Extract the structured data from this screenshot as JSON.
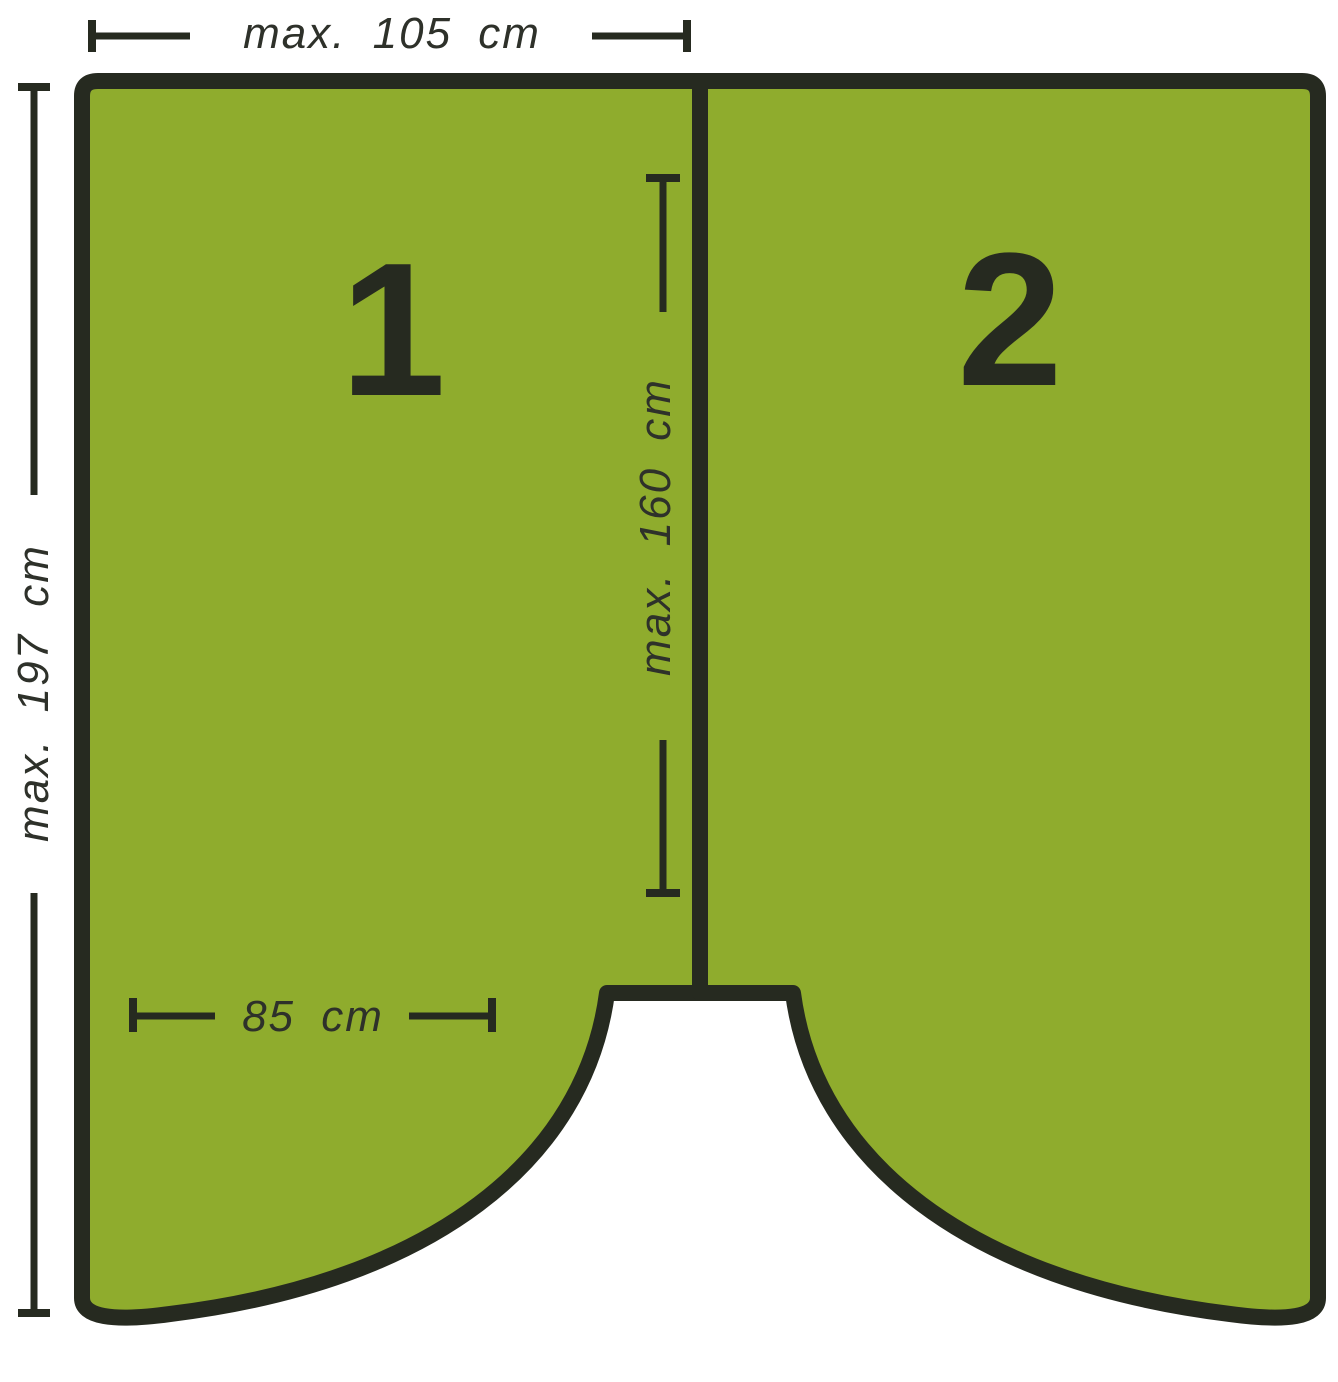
{
  "colors": {
    "panel_green": "#8FAC2D",
    "outline_dark": "#262A20",
    "text_dark": "#2E312A",
    "background": "#FFFFFF"
  },
  "panels": [
    {
      "label": "1"
    },
    {
      "label": "2"
    }
  ],
  "dimensions": {
    "top_width": "max. 105 cm",
    "left_height": "max. 197 cm",
    "center_height": "max. 160 cm",
    "bottom_width": "85 cm"
  }
}
